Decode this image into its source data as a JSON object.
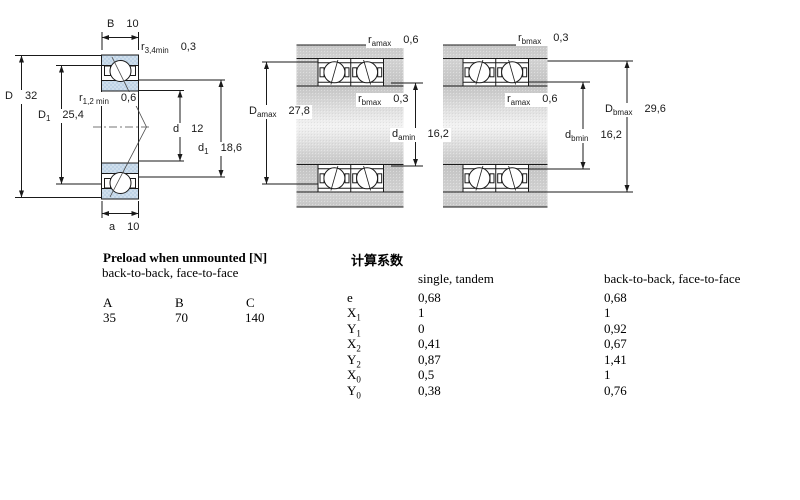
{
  "fig1": {
    "caption": "single angular contact ball bearing cross-section",
    "dims": {
      "B": {
        "sym": "B",
        "sub": "",
        "val": "10"
      },
      "r34": {
        "sym": "r",
        "sub": "3,4min",
        "val": "0,3"
      },
      "D": {
        "sym": "D",
        "sub": "",
        "val": "32"
      },
      "r12": {
        "sym": "r",
        "sub": "1,2 min",
        "val": "0,6"
      },
      "D1": {
        "sym": "D",
        "sub": "1",
        "val": "25,4"
      },
      "d": {
        "sym": "d",
        "sub": "",
        "val": "12"
      },
      "d1": {
        "sym": "d",
        "sub": "1",
        "val": "18,6"
      },
      "a": {
        "sym": "a",
        "sub": "",
        "val": "10"
      }
    }
  },
  "fig2": {
    "caption": "paired bearings mounting, arrangement a",
    "dims": {
      "ramax": {
        "sym": "r",
        "sub": "amax",
        "val": "0,6"
      },
      "rbmax": {
        "sym": "r",
        "sub": "bmax",
        "val": "0,3"
      },
      "Damax": {
        "sym": "D",
        "sub": "amax",
        "val": "27,8"
      },
      "damin": {
        "sym": "d",
        "sub": "amin",
        "val": "16,2"
      }
    }
  },
  "fig3": {
    "caption": "paired bearings mounting, arrangement b",
    "dims": {
      "rbmax": {
        "sym": "r",
        "sub": "bmax",
        "val": "0,3"
      },
      "ramax": {
        "sym": "r",
        "sub": "amax",
        "val": "0,6"
      },
      "Dbmax": {
        "sym": "D",
        "sub": "bmax",
        "val": "29,6"
      },
      "dbmin": {
        "sym": "d",
        "sub": "bmin",
        "val": "16,2"
      }
    }
  },
  "preload": {
    "title": "Preload when unmounted [N]",
    "subtitle": "back-to-back, face-to-face",
    "columns": [
      "A",
      "B",
      "C"
    ],
    "values": [
      "35",
      "70",
      "140"
    ]
  },
  "factors": {
    "title": "计算系数",
    "col1": "single, tandem",
    "col2": "back-to-back, face-to-face",
    "rows": [
      {
        "sym": "e",
        "sub": "",
        "v1": "0,68",
        "v2": "0,68"
      },
      {
        "sym": "X",
        "sub": "1",
        "v1": "1",
        "v2": "1"
      },
      {
        "sym": "Y",
        "sub": "1",
        "v1": "0",
        "v2": "0,92"
      },
      {
        "sym": "X",
        "sub": "2",
        "v1": "0,41",
        "v2": "0,67"
      },
      {
        "sym": "Y",
        "sub": "2",
        "v1": "0,87",
        "v2": "1,41"
      },
      {
        "sym": "X",
        "sub": "0",
        "v1": "0,5",
        "v2": "1"
      },
      {
        "sym": "Y",
        "sub": "0",
        "v1": "0,38",
        "v2": "0,76"
      }
    ]
  },
  "colors": {
    "ring_fill": "#bed3e6",
    "steel_light": "#f2f2f2",
    "steel_dark": "#c6c6c6",
    "line": "#1a1a1a"
  }
}
